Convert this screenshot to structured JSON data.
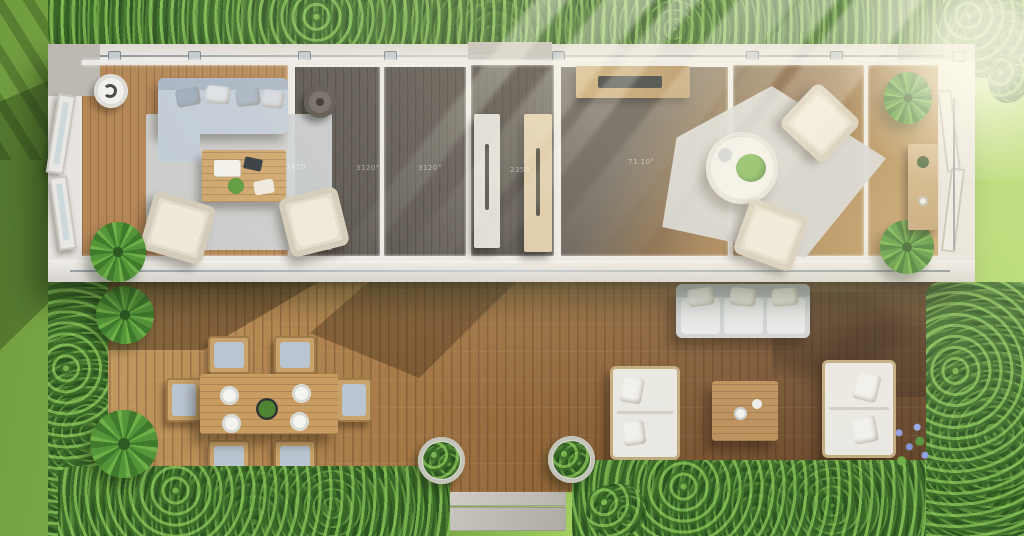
{
  "scene": {
    "title": "Aerial top-down 3D rendering of a long modular container home with glass walls, two furnished living units, and a large wooden garden deck",
    "lighting": "bright daylight with volumetric sun rays entering from the upper right corner",
    "surroundings": "lawn grass on all sides, dense trimmed hedges along the top, left, bottom and right edges of the deck"
  },
  "annotations": {
    "dimension_labels": [
      {
        "text": "1470"
      },
      {
        "text": "3120°"
      },
      {
        "text": "3120°"
      },
      {
        "text": "2350"
      },
      {
        "text": "71.10°"
      }
    ]
  },
  "palette": {
    "grass": "#8cbb50",
    "hedge_green": "#3a6628",
    "deck_wood_light": "#c79e66",
    "deck_wood_dark": "#5e4026",
    "interior_wood": "#b58757",
    "dark_room_floor": "#57524d",
    "wall_white": "#e7e4df",
    "rug_gray": "#cdd2d5",
    "sofa_blue_gray": "#c2ccd7",
    "armchair_beige": "#e2dccd",
    "outdoor_cushion_white": "#e9e8e3",
    "table_wood": "#c99d62",
    "sun_ray": "#fffff2"
  },
  "objects": {
    "left_unit": [
      "round floor lamp",
      "blue-gray sofa with pillows",
      "light gray rug",
      "wooden coffee table with books and plant",
      "two beige armchairs",
      "potted plant",
      "open glass entry doors",
      "dark-floor room with round pouf"
    ],
    "divider": [
      "white door panel with long handle",
      "wooden door panel with long handle"
    ],
    "right_unit": [
      "wooden media console with flat TV",
      "angled light gray rug",
      "round white pedestal table with plant and bowl",
      "two beige armchairs",
      "two potted plants",
      "wooden side console",
      "folding glass doors"
    ],
    "deck": [
      "six-seat wooden dining table with four plates and green centerpiece",
      "outdoor three-seat sofa",
      "two white loveseats facing each other",
      "square wooden coffee table with two cups",
      "two round planters with shrubs",
      "two palm plants",
      "blue wildflowers",
      "stone pavers on grass"
    ]
  }
}
